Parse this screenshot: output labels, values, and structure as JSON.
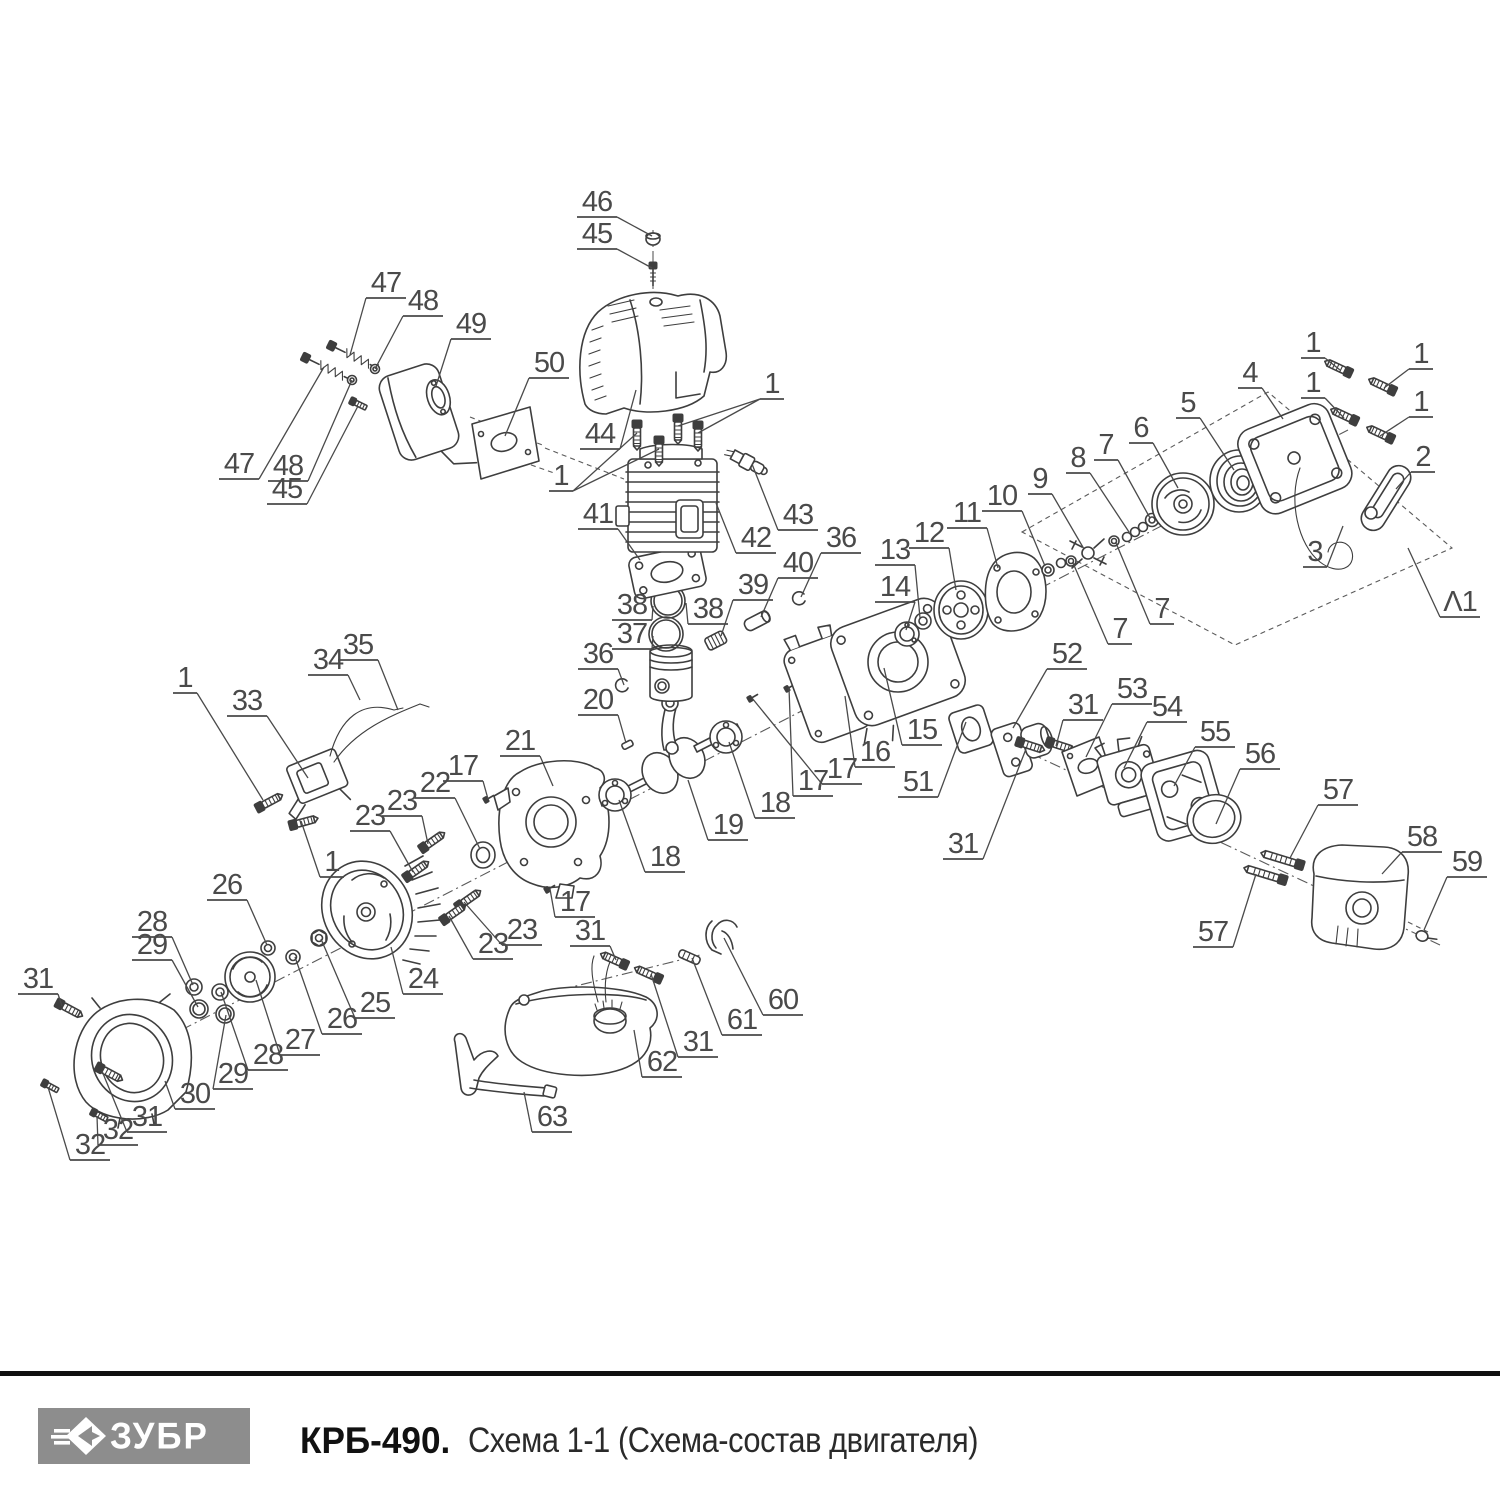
{
  "footer": {
    "brand": "ЗУБР",
    "brand_icon": "zubr-arrow-icon",
    "model": "КРБ-490.",
    "subtitle": "Схема 1-1 (Схема-состав двигателя)"
  },
  "diagram": {
    "description": "Exploded parts diagram of brushcutter engine",
    "line_color": "#3e3e3e",
    "label_color": "#4a4a4a",
    "labels": [
      {
        "t": "46",
        "x": 597,
        "y": 200,
        "to": [
          [
            652,
            236
          ]
        ]
      },
      {
        "t": "45",
        "x": 597,
        "y": 232,
        "to": [
          [
            652,
            268
          ]
        ]
      },
      {
        "t": "44",
        "x": 600,
        "y": 432,
        "to": [
          [
            636,
            390
          ]
        ]
      },
      {
        "t": "1",
        "x": 772,
        "y": 382,
        "to": [
          [
            678,
            426
          ],
          [
            698,
            433
          ]
        ]
      },
      {
        "t": "1",
        "x": 561,
        "y": 474,
        "to": [
          [
            637,
            433
          ],
          [
            659,
            449
          ]
        ]
      },
      {
        "t": "41",
        "x": 598,
        "y": 512,
        "to": [
          [
            640,
            560
          ]
        ]
      },
      {
        "t": "42",
        "x": 756,
        "y": 536,
        "to": [
          [
            716,
            503
          ]
        ]
      },
      {
        "t": "43",
        "x": 798,
        "y": 513,
        "to": [
          [
            752,
            464
          ]
        ]
      },
      {
        "t": "47",
        "x": 386,
        "y": 281,
        "to": [
          [
            350,
            355
          ]
        ]
      },
      {
        "t": "48",
        "x": 423,
        "y": 299,
        "to": [
          [
            375,
            369
          ]
        ]
      },
      {
        "t": "49",
        "x": 471,
        "y": 322,
        "to": [
          [
            436,
            386
          ]
        ]
      },
      {
        "t": "50",
        "x": 549,
        "y": 361,
        "to": [
          [
            505,
            436
          ]
        ]
      },
      {
        "t": "47",
        "x": 239,
        "y": 462,
        "to": [
          [
            324,
            367
          ]
        ]
      },
      {
        "t": "48",
        "x": 288,
        "y": 464,
        "to": [
          [
            352,
            380
          ]
        ]
      },
      {
        "t": "45",
        "x": 287,
        "y": 487,
        "to": [
          [
            358,
            406
          ]
        ]
      },
      {
        "t": "36",
        "x": 841,
        "y": 536,
        "to": [
          [
            801,
            597
          ]
        ]
      },
      {
        "t": "40",
        "x": 798,
        "y": 561,
        "to": [
          [
            761,
            617
          ]
        ]
      },
      {
        "t": "39",
        "x": 753,
        "y": 583,
        "to": [
          [
            721,
            636
          ]
        ]
      },
      {
        "t": "38",
        "x": 632,
        "y": 603,
        "to": [
          [
            653,
            606
          ]
        ]
      },
      {
        "t": "38",
        "x": 708,
        "y": 607,
        "to": [
          [
            686,
            603
          ]
        ]
      },
      {
        "t": "37",
        "x": 632,
        "y": 632,
        "to": [
          [
            653,
            636
          ]
        ]
      },
      {
        "t": "36",
        "x": 598,
        "y": 652,
        "to": [
          [
            624,
            685
          ]
        ]
      },
      {
        "t": "20",
        "x": 598,
        "y": 698,
        "to": [
          [
            626,
            743
          ]
        ]
      },
      {
        "t": "19",
        "x": 728,
        "y": 823,
        "to": [
          [
            688,
            780
          ]
        ]
      },
      {
        "t": "18",
        "x": 775,
        "y": 801,
        "to": [
          [
            729,
            742
          ]
        ]
      },
      {
        "t": "18",
        "x": 665,
        "y": 855,
        "to": [
          [
            619,
            800
          ]
        ]
      },
      {
        "t": "21",
        "x": 520,
        "y": 739,
        "to": [
          [
            553,
            786
          ]
        ]
      },
      {
        "t": "17",
        "x": 463,
        "y": 764,
        "to": [
          [
            488,
            799
          ]
        ]
      },
      {
        "t": "22",
        "x": 435,
        "y": 781,
        "to": [
          [
            480,
            849
          ]
        ]
      },
      {
        "t": "23",
        "x": 402,
        "y": 799,
        "to": [
          [
            428,
            844
          ]
        ]
      },
      {
        "t": "23",
        "x": 370,
        "y": 814,
        "to": [
          [
            413,
            872
          ]
        ]
      },
      {
        "t": "1",
        "x": 332,
        "y": 860,
        "to": [
          [
            301,
            821
          ]
        ]
      },
      {
        "t": "1",
        "x": 185,
        "y": 676,
        "to": [
          [
            263,
            800
          ]
        ]
      },
      {
        "t": "33",
        "x": 247,
        "y": 699,
        "to": [
          [
            308,
            778
          ]
        ]
      },
      {
        "t": "34",
        "x": 328,
        "y": 658,
        "to": [
          [
            360,
            700
          ]
        ]
      },
      {
        "t": "35",
        "x": 358,
        "y": 643,
        "to": [
          [
            398,
            710
          ]
        ]
      },
      {
        "t": "17",
        "x": 575,
        "y": 900,
        "to": [
          [
            550,
            889
          ]
        ]
      },
      {
        "t": "23",
        "x": 522,
        "y": 928,
        "to": [
          [
            464,
            902
          ]
        ]
      },
      {
        "t": "23",
        "x": 493,
        "y": 942,
        "to": [
          [
            449,
            916
          ]
        ]
      },
      {
        "t": "15",
        "x": 922,
        "y": 728,
        "to": [
          [
            884,
            668
          ]
        ]
      },
      {
        "t": "16",
        "x": 875,
        "y": 750,
        "to": [
          [
            845,
            696
          ]
        ]
      },
      {
        "t": "17",
        "x": 842,
        "y": 767,
        "to": [
          [
            752,
            698
          ]
        ]
      },
      {
        "t": "17",
        "x": 813,
        "y": 779,
        "to": [
          [
            789,
            688
          ]
        ]
      },
      {
        "t": "14",
        "x": 895,
        "y": 585,
        "to": [
          [
            906,
            630
          ]
        ]
      },
      {
        "t": "13",
        "x": 895,
        "y": 548,
        "to": [
          [
            920,
            618
          ]
        ]
      },
      {
        "t": "12",
        "x": 929,
        "y": 531,
        "to": [
          [
            956,
            590
          ]
        ]
      },
      {
        "t": "11",
        "x": 967,
        "y": 511,
        "to": [
          [
            998,
            568
          ]
        ]
      },
      {
        "t": "10",
        "x": 1002,
        "y": 494,
        "to": [
          [
            1045,
            566
          ]
        ]
      },
      {
        "t": "9",
        "x": 1040,
        "y": 477,
        "to": [
          [
            1084,
            549
          ]
        ]
      },
      {
        "t": "8",
        "x": 1078,
        "y": 456,
        "to": [
          [
            1129,
            532
          ]
        ]
      },
      {
        "t": "7",
        "x": 1106,
        "y": 443,
        "to": [
          [
            1150,
            518
          ]
        ]
      },
      {
        "t": "7",
        "x": 1162,
        "y": 607,
        "to": [
          [
            1116,
            543
          ]
        ]
      },
      {
        "t": "7",
        "x": 1120,
        "y": 627,
        "to": [
          [
            1073,
            563
          ]
        ]
      },
      {
        "t": "6",
        "x": 1141,
        "y": 426,
        "to": [
          [
            1178,
            488
          ]
        ]
      },
      {
        "t": "5",
        "x": 1188,
        "y": 401,
        "to": [
          [
            1234,
            470
          ]
        ]
      },
      {
        "t": "4",
        "x": 1250,
        "y": 371,
        "to": [
          [
            1283,
            419
          ]
        ]
      },
      {
        "t": "1",
        "x": 1313,
        "y": 341,
        "to": [
          [
            1340,
            370
          ]
        ]
      },
      {
        "t": "1",
        "x": 1421,
        "y": 352,
        "to": [
          [
            1384,
            388
          ]
        ]
      },
      {
        "t": "1",
        "x": 1313,
        "y": 381,
        "to": [
          [
            1344,
            418
          ]
        ]
      },
      {
        "t": "1",
        "x": 1421,
        "y": 400,
        "to": [
          [
            1380,
            436
          ]
        ]
      },
      {
        "t": "2",
        "x": 1423,
        "y": 455,
        "to": [
          [
            1396,
            489
          ]
        ]
      },
      {
        "t": "3",
        "x": 1315,
        "y": 550,
        "to": [
          [
            1343,
            526
          ]
        ]
      },
      {
        "t": "Λ1",
        "x": 1460,
        "y": 600,
        "to": [
          [
            1408,
            548
          ]
        ]
      },
      {
        "t": "52",
        "x": 1067,
        "y": 652,
        "to": [
          [
            1013,
            728
          ]
        ]
      },
      {
        "t": "51",
        "x": 918,
        "y": 780,
        "to": [
          [
            966,
            722
          ]
        ]
      },
      {
        "t": "31",
        "x": 963,
        "y": 842,
        "to": [
          [
            1026,
            749
          ]
        ]
      },
      {
        "t": "31",
        "x": 1083,
        "y": 703,
        "to": [
          [
            1056,
            746
          ]
        ]
      },
      {
        "t": "53",
        "x": 1132,
        "y": 687,
        "to": [
          [
            1086,
            757
          ]
        ]
      },
      {
        "t": "54",
        "x": 1167,
        "y": 705,
        "to": [
          [
            1124,
            768
          ]
        ]
      },
      {
        "t": "55",
        "x": 1215,
        "y": 730,
        "to": [
          [
            1174,
            786
          ]
        ]
      },
      {
        "t": "56",
        "x": 1260,
        "y": 752,
        "to": [
          [
            1216,
            824
          ]
        ]
      },
      {
        "t": "57",
        "x": 1338,
        "y": 788,
        "to": [
          [
            1290,
            858
          ]
        ]
      },
      {
        "t": "57",
        "x": 1213,
        "y": 930,
        "to": [
          [
            1256,
            874
          ]
        ]
      },
      {
        "t": "58",
        "x": 1422,
        "y": 835,
        "to": [
          [
            1382,
            874
          ]
        ]
      },
      {
        "t": "59",
        "x": 1467,
        "y": 860,
        "to": [
          [
            1424,
            930
          ]
        ]
      },
      {
        "t": "26",
        "x": 227,
        "y": 883,
        "to": [
          [
            267,
            945
          ]
        ]
      },
      {
        "t": "28",
        "x": 152,
        "y": 920,
        "to": [
          [
            193,
            985
          ]
        ]
      },
      {
        "t": "29",
        "x": 152,
        "y": 943,
        "to": [
          [
            198,
            1007
          ]
        ]
      },
      {
        "t": "31",
        "x": 38,
        "y": 977,
        "to": [
          [
            62,
            1006
          ]
        ]
      },
      {
        "t": "24",
        "x": 423,
        "y": 977,
        "to": [
          [
            391,
            947
          ]
        ]
      },
      {
        "t": "25",
        "x": 375,
        "y": 1001,
        "to": [
          [
            321,
            939
          ]
        ]
      },
      {
        "t": "26",
        "x": 342,
        "y": 1017,
        "to": [
          [
            295,
            957
          ]
        ]
      },
      {
        "t": "27",
        "x": 300,
        "y": 1038,
        "to": [
          [
            256,
            980
          ]
        ]
      },
      {
        "t": "28",
        "x": 268,
        "y": 1053,
        "to": [
          [
            221,
            992
          ]
        ]
      },
      {
        "t": "29",
        "x": 233,
        "y": 1072,
        "to": [
          [
            226,
            1015
          ]
        ]
      },
      {
        "t": "30",
        "x": 195,
        "y": 1092,
        "to": [
          [
            165,
            1081
          ]
        ]
      },
      {
        "t": "31",
        "x": 147,
        "y": 1115,
        "to": [
          [
            102,
            1071
          ]
        ]
      },
      {
        "t": "32",
        "x": 118,
        "y": 1128,
        "to": [
          [
            97,
            1116
          ]
        ]
      },
      {
        "t": "32",
        "x": 90,
        "y": 1143,
        "to": [
          [
            48,
            1087
          ]
        ]
      },
      {
        "t": "31",
        "x": 590,
        "y": 929,
        "to": [
          [
            616,
            960
          ]
        ]
      },
      {
        "t": "60",
        "x": 783,
        "y": 998,
        "to": [
          [
            724,
            938
          ]
        ]
      },
      {
        "t": "61",
        "x": 742,
        "y": 1018,
        "to": [
          [
            692,
            958
          ]
        ]
      },
      {
        "t": "31",
        "x": 698,
        "y": 1040,
        "to": [
          [
            651,
            974
          ]
        ]
      },
      {
        "t": "62",
        "x": 662,
        "y": 1060,
        "to": [
          [
            634,
            1030
          ]
        ]
      },
      {
        "t": "63",
        "x": 552,
        "y": 1115,
        "to": [
          [
            524,
            1092
          ]
        ]
      }
    ]
  }
}
